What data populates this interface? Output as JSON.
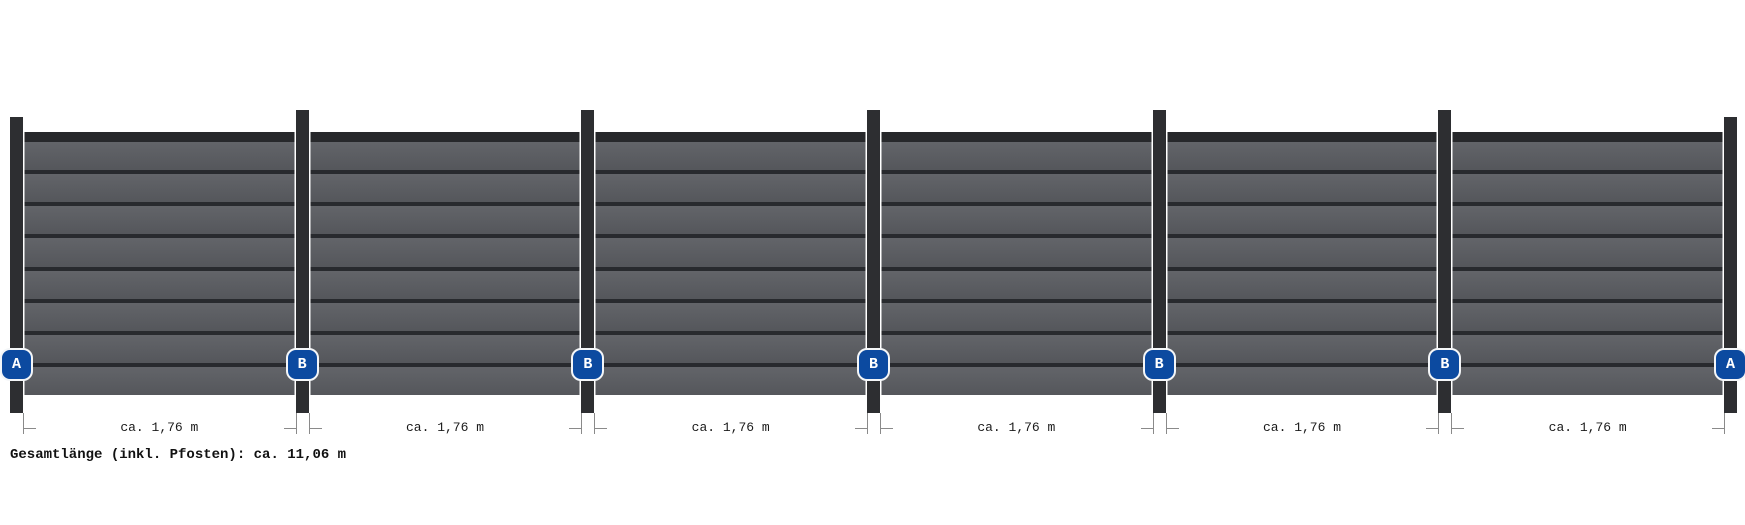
{
  "diagram_type": "fence-elevation",
  "posts": [
    {
      "label": "A"
    },
    {
      "label": "B"
    },
    {
      "label": "B"
    },
    {
      "label": "B"
    },
    {
      "label": "B"
    },
    {
      "label": "B"
    },
    {
      "label": "A"
    }
  ],
  "panels": [
    {
      "dimension_label": "ca. 1,76 m"
    },
    {
      "dimension_label": "ca. 1,76 m"
    },
    {
      "dimension_label": "ca. 1,76 m"
    },
    {
      "dimension_label": "ca. 1,76 m"
    },
    {
      "dimension_label": "ca. 1,76 m"
    },
    {
      "dimension_label": "ca. 1,76 m"
    }
  ],
  "planks_per_panel": 8,
  "total_length_label": "Gesamtlänge (inkl. Pfosten): ca. 11,06 m",
  "colors": {
    "background": "#ffffff",
    "post": "#2d2e31",
    "post_edge": "#ffffff",
    "top_rail": "#27282b",
    "plank": "#5a5c61",
    "plank_separator": "#282a2e",
    "badge_fill": "#0c4aa0",
    "badge_border": "#f4f6f8",
    "badge_text": "#ffffff",
    "dimension_line": "#8a8a8a",
    "dimension_text": "#1a1a1a",
    "total_text": "#111111"
  }
}
